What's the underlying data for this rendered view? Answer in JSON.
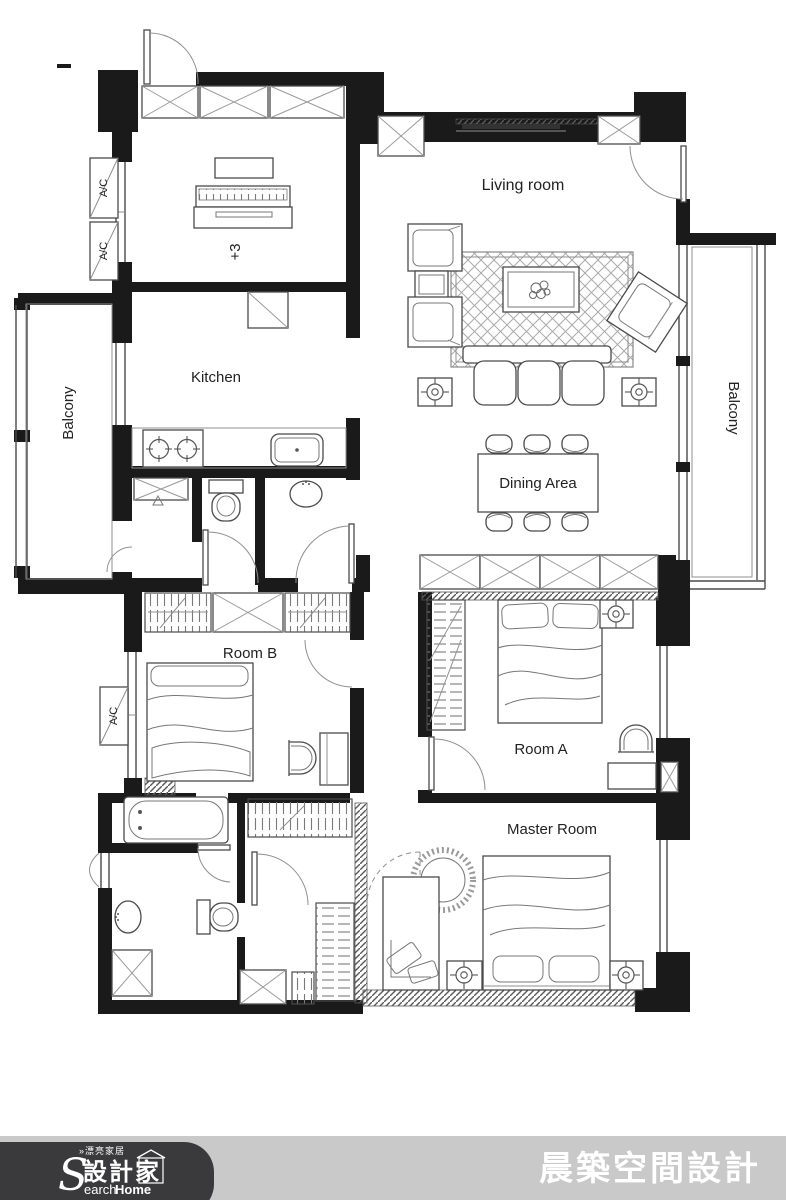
{
  "plan": {
    "rooms": {
      "living_room": "Living room",
      "kitchen": "Kitchen",
      "dining_area": "Dining Area",
      "room_a": "Room A",
      "room_b": "Room B",
      "master_room": "Master Room",
      "balcony_left": "Balcony",
      "balcony_right": "Balcony"
    },
    "annotations": {
      "floor_level": "+3",
      "ac_unit": "A/C"
    }
  },
  "footer": {
    "company_name": "晨築空間設計",
    "logo": {
      "tagline": "»漂亮家居",
      "brand_zh": "設計家",
      "brand_initial": "S",
      "brand_rest": "earch",
      "brand_bold": "Home"
    }
  },
  "colors": {
    "wall": "#1a1a1a",
    "footer_bar": "#c9c9c9",
    "logo_bg": "#3a3a3c",
    "footer_text": "#ffffff"
  }
}
